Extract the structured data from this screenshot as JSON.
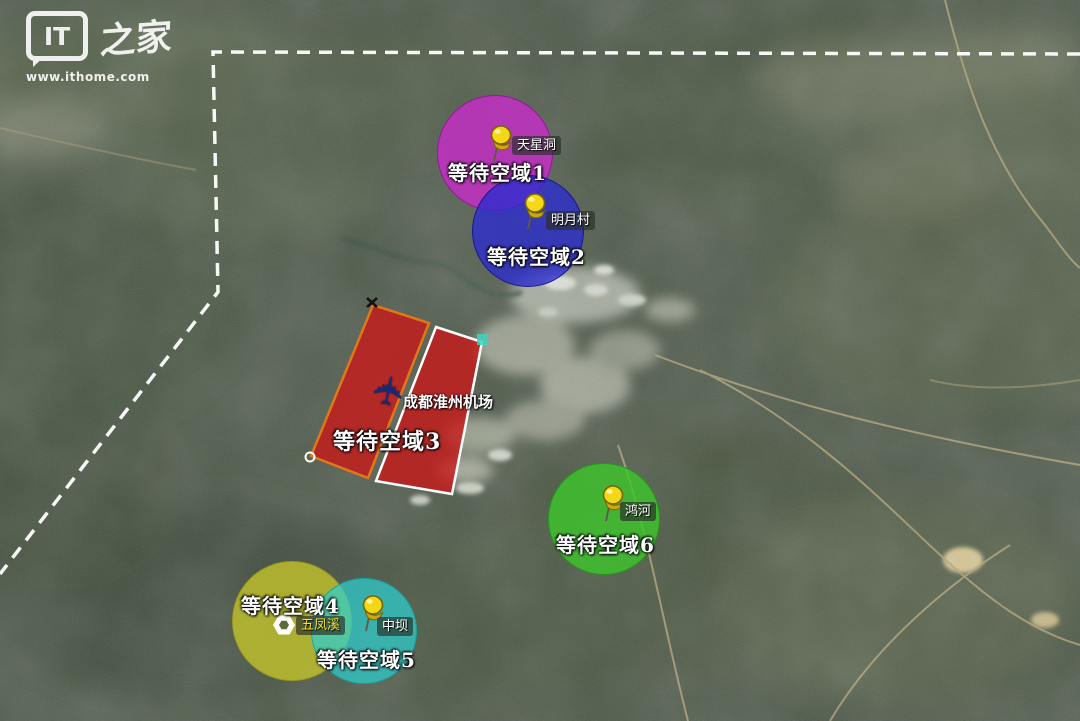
{
  "watermark": {
    "logo": "IT",
    "logo_cn": "之家",
    "url": "www.ithome.com"
  },
  "airport": {
    "name": "成都淮州机场"
  },
  "icons": {
    "airport_plane": "✈"
  },
  "boundary": {
    "color": "#ffffff",
    "style": "dashed"
  },
  "pin_color": "#f4d818",
  "zones": [
    {
      "label": "等待空域1",
      "pin": "天星洞",
      "shape": "circle",
      "color": "#c92ccb"
    },
    {
      "label": "等待空域2",
      "pin": "明月村",
      "shape": "circle",
      "color": "#2b2bd0"
    },
    {
      "label": "等待空域3",
      "pin": "",
      "shape": "rectangle-pair",
      "color": "#c81919",
      "border_colors": [
        "#e07818",
        "#ffffff"
      ]
    },
    {
      "label": "等待空域4",
      "pin": "五凤溪",
      "shape": "circle",
      "color": "#c6c62a"
    },
    {
      "label": "等待空域5",
      "pin": "中坝",
      "shape": "circle",
      "color": "#2ecece"
    },
    {
      "label": "等待空域6",
      "pin": "鸿河",
      "shape": "circle",
      "color": "#3ec42c"
    }
  ]
}
